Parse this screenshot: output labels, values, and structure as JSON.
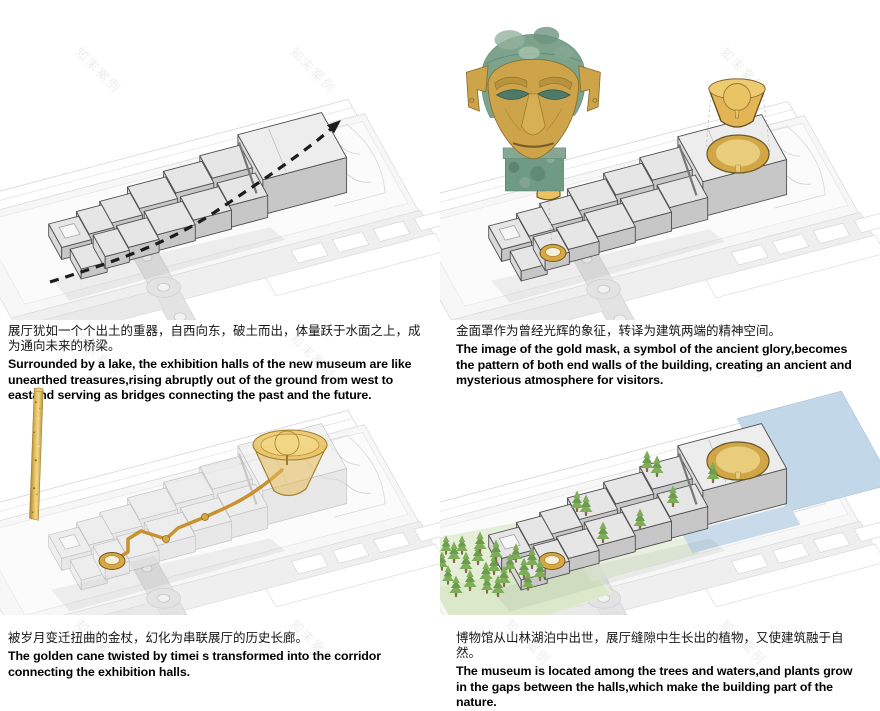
{
  "watermark": "知末案例",
  "panels": [
    {
      "id": "unearthed-halls",
      "figure": "massing-diagram-with-circulation-arrow",
      "cn": "展厅犹如一个个出土的重器，自西向东，破土而出，体量跃于水面之上，成为通向未来的桥梁。",
      "en": "Surrounded by a lake, the exhibition halls of the new museum are like unearthed treasures,rising abruptly out of the ground from west to eastand serving as bridges connecting the past and the future."
    },
    {
      "id": "gold-mask",
      "figure": "bronze-head-with-gold-mask-and-massing-diagram",
      "cn": "金面罩作为曾经光辉的象征，转译为建筑两端的精神空间。",
      "en": "The image of the gold mask, a symbol of the ancient glory,becomes the pattern of both end walls of the building, creating an ancient and mysterious atmosphere for visitors."
    },
    {
      "id": "golden-cane",
      "figure": "golden-cane-and-corridor-diagram",
      "cn": "被岁月变迁扭曲的金杖，幻化为串联展厅的历史长廊。",
      "en": "The golden cane twisted by timei s transformed into the corridor connecting the exhibition halls."
    },
    {
      "id": "nature",
      "figure": "massing-diagram-with-trees-and-water",
      "cn": "博物馆从山林湖泊中出世，展厅缝隙中生长出的植物，又使建筑融于自然。",
      "en": "The museum is located among the trees and waters,and plants grow in the gaps between the halls,which make the building part of the nature."
    }
  ],
  "colors": {
    "gold": "#d9a843",
    "gold_light": "#eccb72",
    "gold_dark": "#8a6d2a",
    "gold_outline": "#6b5520",
    "corridor": "#c9922f",
    "bronze_green": "#7da38d",
    "bronze_dark": "#5c8671",
    "tree_green": "#6d9c4e",
    "tree_light": "#7fae59",
    "water": "#c2d7e8",
    "lawn": "#e4eed8",
    "block_top": "#e6e6e6",
    "block_side": "#c7c7c7",
    "block_west": "#dadada",
    "outline": "#4f4f4f",
    "arrow": "#1c1c1c"
  }
}
